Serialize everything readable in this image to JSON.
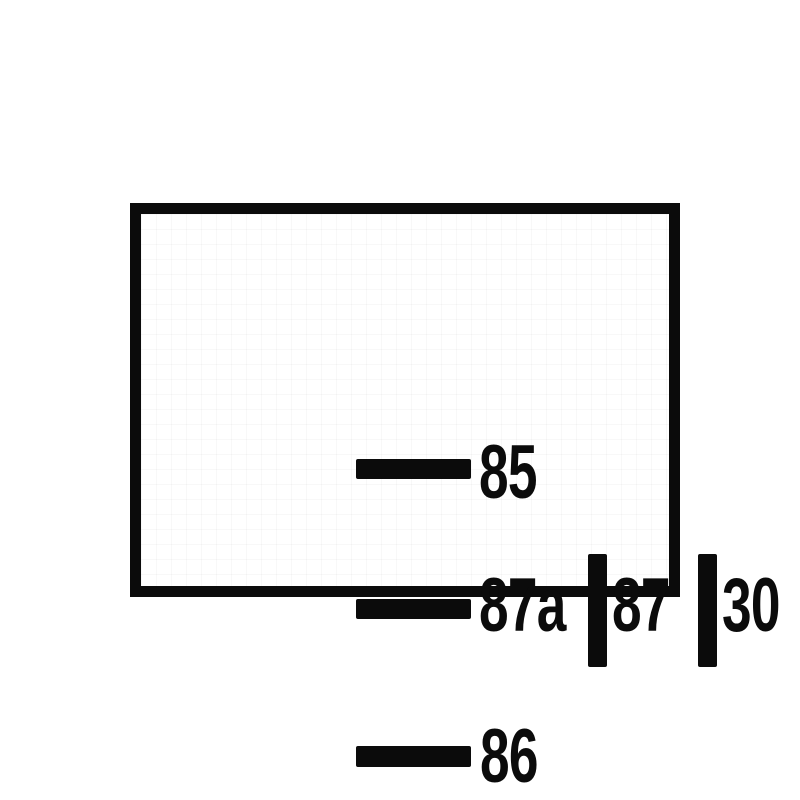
{
  "diagram": {
    "kind": "relay-terminal-pinout",
    "colors": {
      "ink": "#0b0b0b",
      "background": "#ffffff"
    },
    "pins": [
      {
        "label": "85",
        "terminal": "horizontal-blade"
      },
      {
        "label": "87a",
        "terminal": "horizontal-blade"
      },
      {
        "label": "87",
        "terminal": "vertical-blade"
      },
      {
        "label": "30",
        "terminal": "vertical-blade"
      },
      {
        "label": "86",
        "terminal": "horizontal-blade"
      }
    ]
  }
}
